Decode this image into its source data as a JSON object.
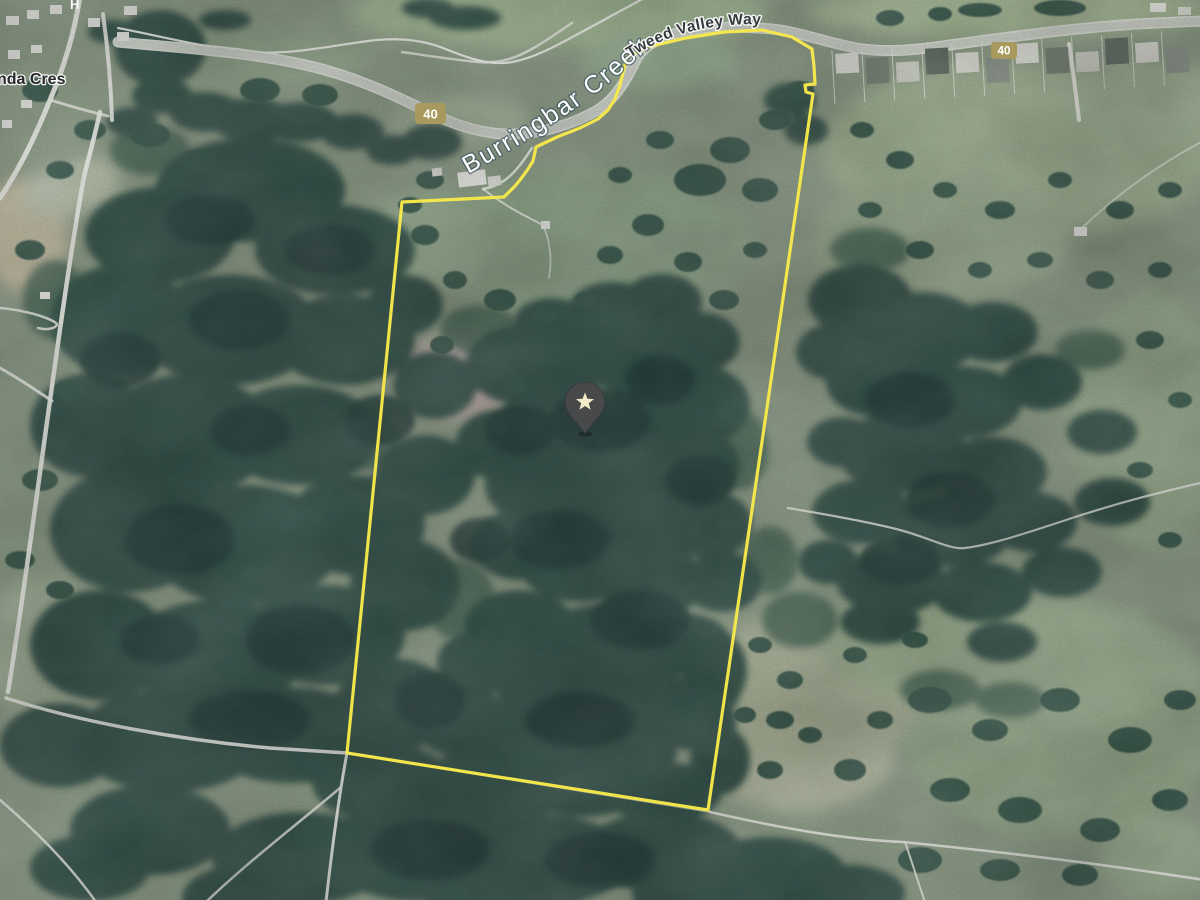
{
  "labels": {
    "creek": "Burringbar Creek",
    "highway": "Tweed Valley Way",
    "street_partial": "nda Cres",
    "top_edge_partial": "H"
  },
  "route_shields": [
    {
      "label": "40",
      "transform": "translate(415,103)"
    },
    {
      "label": "40",
      "transform": "translate(991,42)"
    }
  ],
  "marker": {
    "kind": "saved-place-star-pin",
    "transform": "translate(585,407)"
  },
  "boundary": {
    "points": "627,57 652,46 686,38 724,32 762,30 792,37 812,49 814,66 815,84 805,85 806,92 813,94 708,810 347,753 402,202 504,197 516,185 523,176 528,169 533,161 536,147 557,137 580,128 598,119 608,110 615,99 620,85",
    "color": "#f6e84b"
  },
  "colors": {
    "base": "#8a9a84",
    "boundary": "#f6e84b",
    "shield": "#a89a5e",
    "pin-body": "#47494b",
    "pin-star": "#f2ebc7",
    "road": "#edefe9",
    "highway": "#cfd5cb",
    "highway-casing": "#e9ece6",
    "forest1": "#2f4d44",
    "forest2": "#223c37",
    "forest3": "#40614f",
    "tree": "#35544a",
    "creek-label": "#ffffff",
    "road-label": "#363b3f"
  }
}
